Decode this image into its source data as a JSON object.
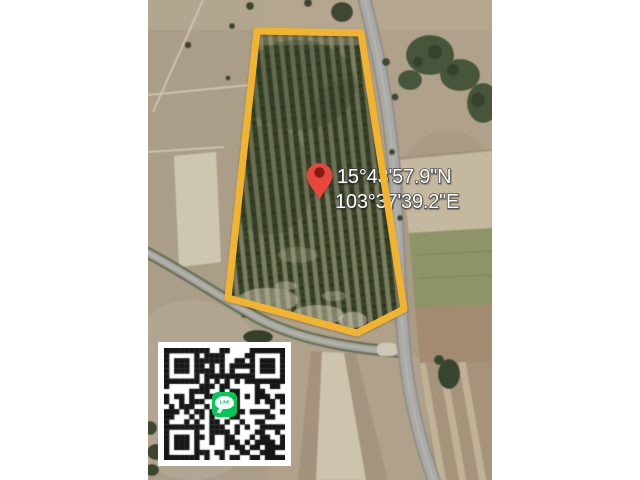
{
  "map": {
    "coordinates": {
      "latitude": "15°43'57.9\"N",
      "longitude": "103°37'39.2\"E"
    },
    "colors": {
      "parcel_outline": "#F2B32E",
      "pin": "#E8453C",
      "pin_core": "#7F1D12",
      "label_text": "#FFFFFF",
      "road": "#A9A9A6"
    }
  },
  "qr": {
    "center_logo_label": "LINE",
    "logo_color": "#06C755",
    "dark_color": "#161616",
    "light_color": "#FFFFFF",
    "modules": 24,
    "seed": 1337
  }
}
